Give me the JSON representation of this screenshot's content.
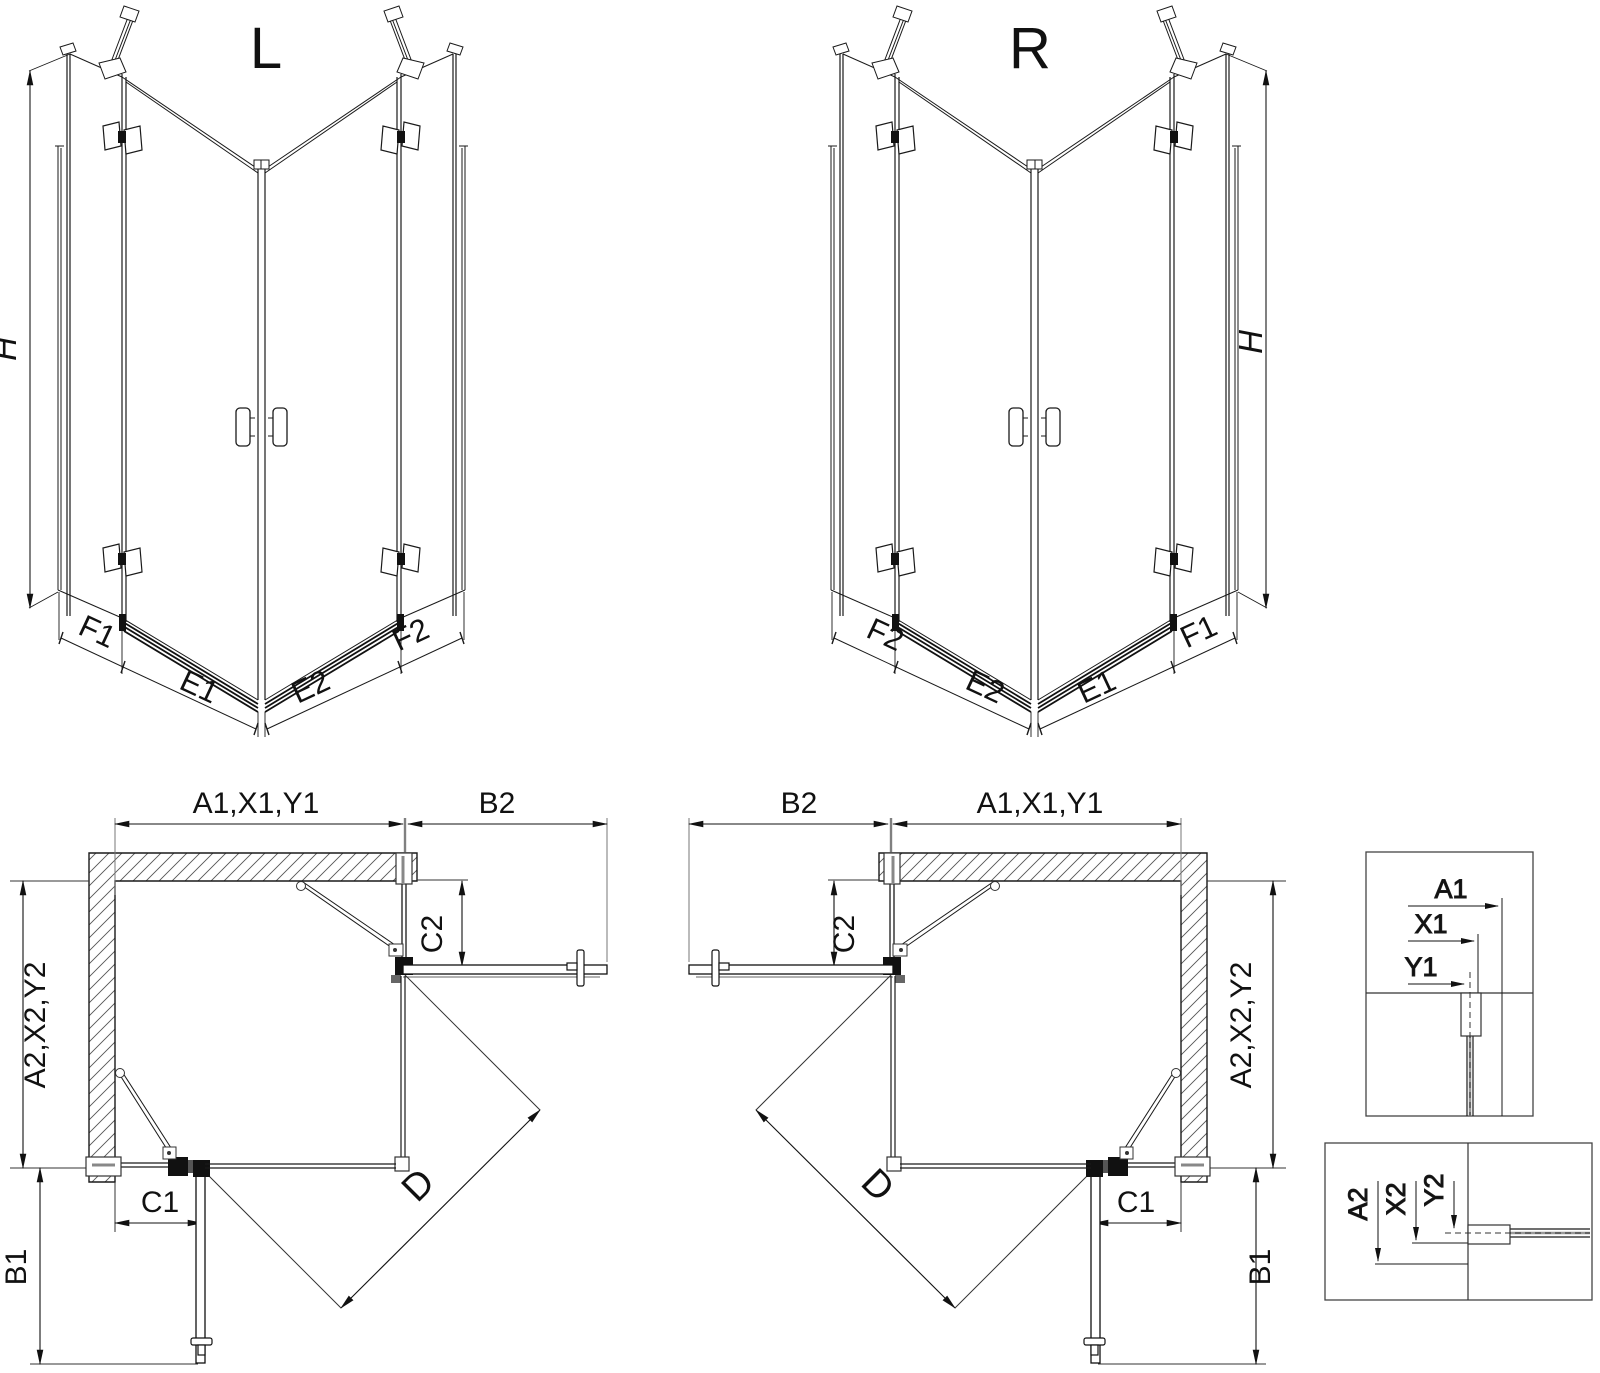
{
  "drawing": {
    "iso_left": {
      "title": "L",
      "height_label": "H",
      "base_labels": [
        "F1",
        "E1",
        "E2",
        "F2"
      ]
    },
    "iso_right": {
      "title": "R",
      "height_label": "H",
      "base_labels": [
        "F2",
        "E2",
        "E1",
        "F1"
      ]
    },
    "plan_left": {
      "top_width": "A1,X1,Y1",
      "door_width": "B2",
      "side_depth": "A2,X2,Y2",
      "fixed_top": "C2",
      "fixed_bottom": "C1",
      "door_depth": "B1",
      "diagonal": "D"
    },
    "plan_right": {
      "top_width": "A1,X1,Y1",
      "door_width": "B2",
      "side_depth": "A2,X2,Y2",
      "fixed_top": "C2",
      "fixed_bottom": "C1",
      "door_depth": "B1",
      "diagonal": "D"
    },
    "detail_width": {
      "labels": [
        "A1",
        "X1",
        "Y1"
      ]
    },
    "detail_depth": {
      "labels": [
        "A2",
        "X2",
        "Y2"
      ]
    },
    "colors": {
      "line": "#1a1a1a",
      "hatch": "#555555",
      "accent_gray": "#888888",
      "background": "#ffffff"
    }
  }
}
